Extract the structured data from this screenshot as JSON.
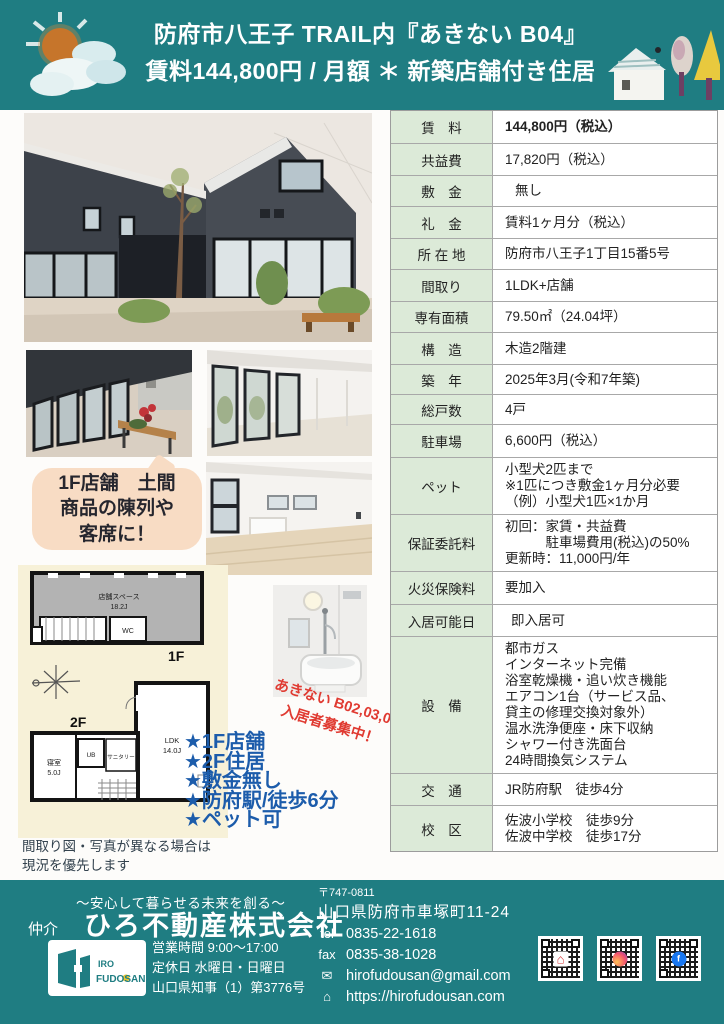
{
  "header": {
    "title_line1": "防府市八王子 TRAIL内『あきない B04』",
    "title_line2": "賃料144,800円 / 月額 ＊ 新築店舗付き住居"
  },
  "bubble": {
    "text": "1F店舗　土間\n商品の陳列や\n客席に！"
  },
  "promo": {
    "rotated": "あきない B02,03,05\n入居者募集中！",
    "stars": [
      "★1F店舗",
      "★2F住居",
      "★敷金無し",
      "★防府駅/徒歩6分",
      "★ペット可"
    ]
  },
  "floorplan": {
    "store_name": "店舗スペース",
    "store_size": "18.2J",
    "wc": "WC",
    "f1": "1F",
    "f2": "2F",
    "bedroom_name": "寝室",
    "bedroom_size": "5.0J",
    "ub": "UB",
    "sanitary": "サニタリー",
    "ldk_name": "LDK",
    "ldk_size": "14.0J",
    "note": "間取り図・写真が異なる場合は\n現況を優先します"
  },
  "table": {
    "rows": [
      {
        "label": "賃　料",
        "value": "144,800円（税込）"
      },
      {
        "label": "共益費",
        "value": "17,820円（税込）"
      },
      {
        "label": "敷　金",
        "value": "無し"
      },
      {
        "label": "礼　金",
        "value": "賃料1ヶ月分（税込）"
      },
      {
        "label": "所 在 地",
        "value": "防府市八王子1丁目15番5号"
      },
      {
        "label": "間取り",
        "value": "1LDK+店舗"
      },
      {
        "label": "専有面積",
        "value": "79.50㎡（24.04坪）"
      },
      {
        "label": "構　造",
        "value": "木造2階建"
      },
      {
        "label": "築　年",
        "value": "2025年3月(令和7年築)"
      },
      {
        "label": "総戸数",
        "value": "4戸"
      },
      {
        "label": "駐車場",
        "value": "6,600円（税込）"
      },
      {
        "label": "ペット",
        "value": "小型犬2匹まで\n※1匹につき敷金1ヶ月分必要\n（例）小型犬1匹×1か月"
      },
      {
        "label": "保証委託料",
        "value": "初回：家賃・共益費\n　　　駐車場費用(税込)の50%\n更新時：11,000円/年"
      },
      {
        "label": "火災保険料",
        "value": "要加入"
      },
      {
        "label": "入居可能日",
        "value": "即入居可"
      },
      {
        "label": "設　備",
        "value": "都市ガス\nインターネット完備\n浴室乾燥機・追い炊き機能\nエアコン1台（サービス品、\n貸主の修理交換対象外）\n温水洗浄便座・床下収納\nシャワー付き洗面台\n24時間換気システム"
      },
      {
        "label": "交　通",
        "value": "JR防府駅　徒歩4分"
      },
      {
        "label": "校　区",
        "value": "佐波小学校　徒歩9分\n佐波中学校　徒歩17分"
      }
    ]
  },
  "footer": {
    "tagline": "〜安心して暮らせる未来を創る〜",
    "broker": "仲介",
    "company": "ひろ不動産株式会社",
    "logo_line1": "IRO",
    "logo_line2": "FUDOSAN",
    "business": "営業時間 9:00〜17:00\n定休日 水曜日・日曜日\n山口県知事（1）第3776号",
    "postal": "〒747-0811",
    "address": "山口県防府市車塚町11-24",
    "tel_label": "tel",
    "tel": "0835-22-1618",
    "fax_label": "fax",
    "fax": "0835-38-1028",
    "email_icon": "✉",
    "email": "hirofudousan@gmail.com",
    "url_icon": "⌂",
    "url": "https://hirofudousan.com",
    "facebook_f": "f"
  },
  "colors": {
    "teal": "#1f7d82",
    "table_label_bg": "#dcead8",
    "star_blue": "#1c5cab",
    "promo_red": "#e03a31",
    "bubble_bg": "#f8dcc4"
  }
}
